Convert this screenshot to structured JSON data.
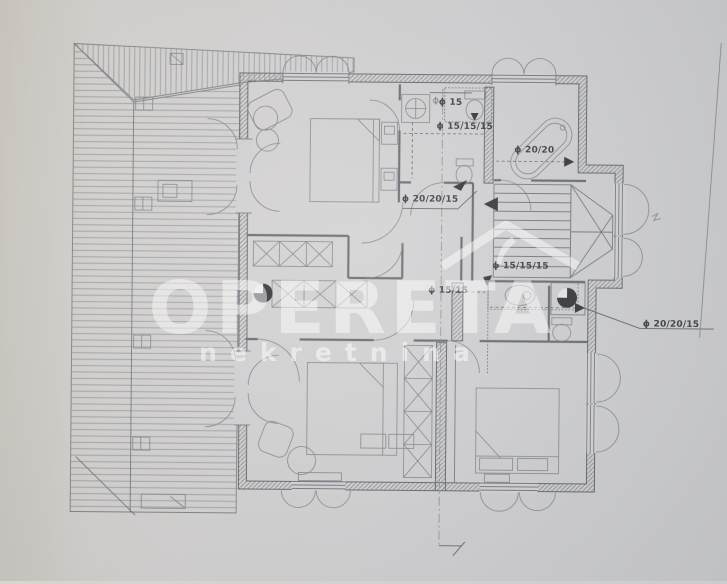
{
  "watermark": {
    "brand": "OPERETA",
    "subtitle": "nekretnina",
    "logo": "roof-logo"
  },
  "plan": {
    "type": "architectural-floor-plan",
    "labels": [
      {
        "id": "pipe-dia-wc-basin",
        "text": "ϕ 15"
      },
      {
        "id": "pipe-dia-wc-stack",
        "text": "ϕ 15/15/15"
      },
      {
        "id": "pipe-dia-bathtub",
        "text": "ϕ 20/20"
      },
      {
        "id": "pipe-dia-left-stack",
        "text": "ϕ 20/20/15"
      },
      {
        "id": "pipe-dia-shower-stack",
        "text": "ϕ 15/15/15"
      },
      {
        "id": "pipe-dia-shower",
        "text": "ϕ 15/15"
      },
      {
        "id": "pipe-dia-right-stack",
        "text": "ϕ 20/20/15"
      }
    ]
  },
  "colors": {
    "paper": "#d0d0d2",
    "paper_warm": "#d8d4ce",
    "ink": "#71757c",
    "label_ink": "#383b41",
    "watermark": "rgba(255,255,255,0.52)"
  }
}
